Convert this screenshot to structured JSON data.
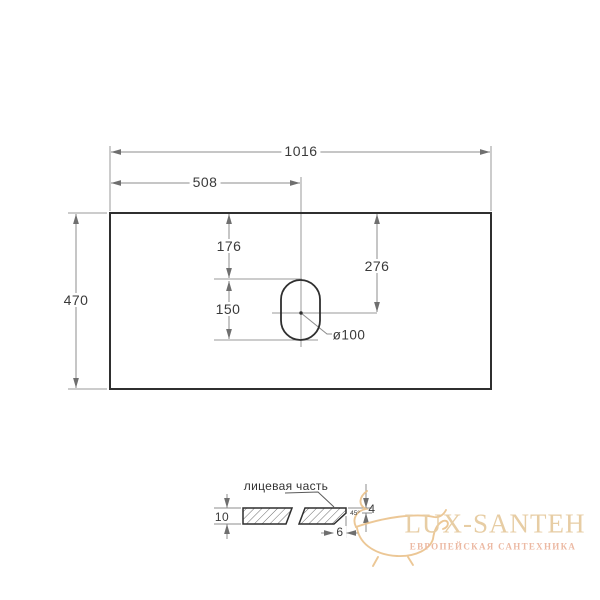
{
  "drawing": {
    "top_view": {
      "total_width": "1016",
      "half_width": "508",
      "depth": "470",
      "hole_top_offset": "176",
      "hole_center_offset": "276",
      "hole_height": "150",
      "hole_diameter": "ø100"
    },
    "section_view": {
      "face_label": "лицевая часть",
      "thickness": "10",
      "edge_height": "4",
      "chamfer_angle": "45°",
      "chamfer_width": "6"
    },
    "colors": {
      "outline": "#2f2f2f",
      "dimension": "#8c8c8c",
      "watermark_gold": "#e7cda4",
      "watermark_pink": "#ecb9a3",
      "watermark_tub": "#eac28b"
    }
  },
  "watermark": {
    "brand": "LUX-SANTEH",
    "tagline": "ЕВРОПЕЙСКАЯ САНТЕХНИКА",
    "logo": "bathtub-icon"
  }
}
